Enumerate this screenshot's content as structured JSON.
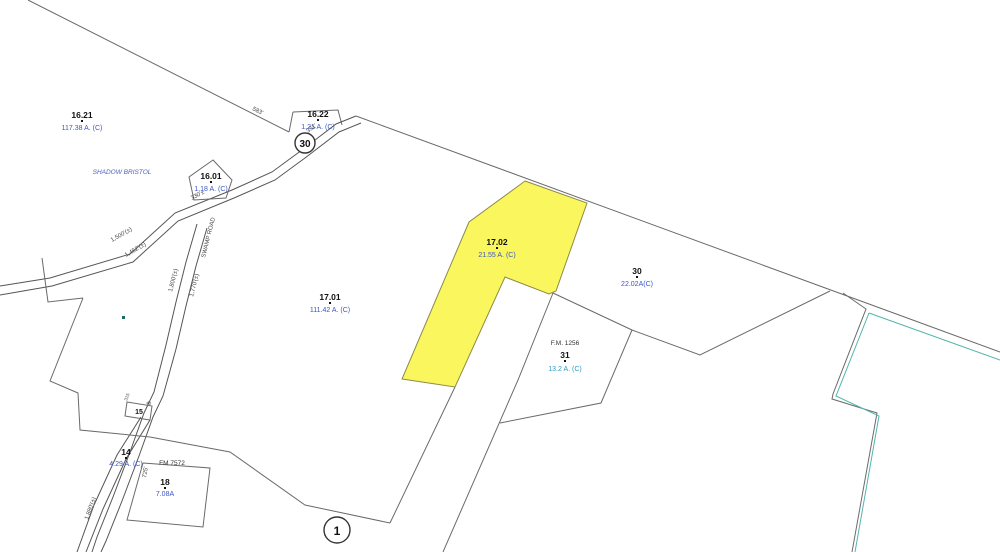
{
  "map": {
    "parcels": {
      "p1621": {
        "id": "16.21",
        "area": "117.38 A. (C)"
      },
      "p1622": {
        "id": "16.22",
        "area": "1.21 A. (C)"
      },
      "p1601": {
        "id": "16.01",
        "area": "1.18 A. (C)"
      },
      "p1701": {
        "id": "17.01",
        "area": "111.42 A. (C)"
      },
      "p1702": {
        "id": "17.02",
        "area": "21.55 A. (C)"
      },
      "p30": {
        "id": "30",
        "area": "22.02A(C)"
      },
      "p31": {
        "id": "31",
        "area": "13.2 A. (C)",
        "fm": "F.M. 1256"
      },
      "p14": {
        "id": "14",
        "area": "4.29 A. (C)"
      },
      "p15": {
        "id": "15"
      },
      "p18": {
        "id": "18",
        "area": "7.08A"
      }
    },
    "roads": {
      "shield": "30",
      "swamp_road": "SWAMP ROAD",
      "fm7572": "FM 7572"
    },
    "annotations": {
      "subdivision": "SHADOW BRISTOL",
      "sheet_index": "1"
    },
    "dimensions": {
      "d583": "583'",
      "d331": "331'",
      "d330": "330'±",
      "d1500": "1,500'(±)",
      "d1452": "1,452'(±)",
      "d1800": "1,800'(±)",
      "d1770": "1,770'(±)",
      "d1880": "1,880'(±)",
      "d725": "725'",
      "d315": "315",
      "d40": "40"
    },
    "colors": {
      "highlight_fill": "#f9f65e",
      "parcel_line": "#6a6a6a",
      "label_blue": "#3a57c4",
      "label_cyan": "#2e9bbf",
      "survey_teal": "#52b5ac"
    }
  }
}
